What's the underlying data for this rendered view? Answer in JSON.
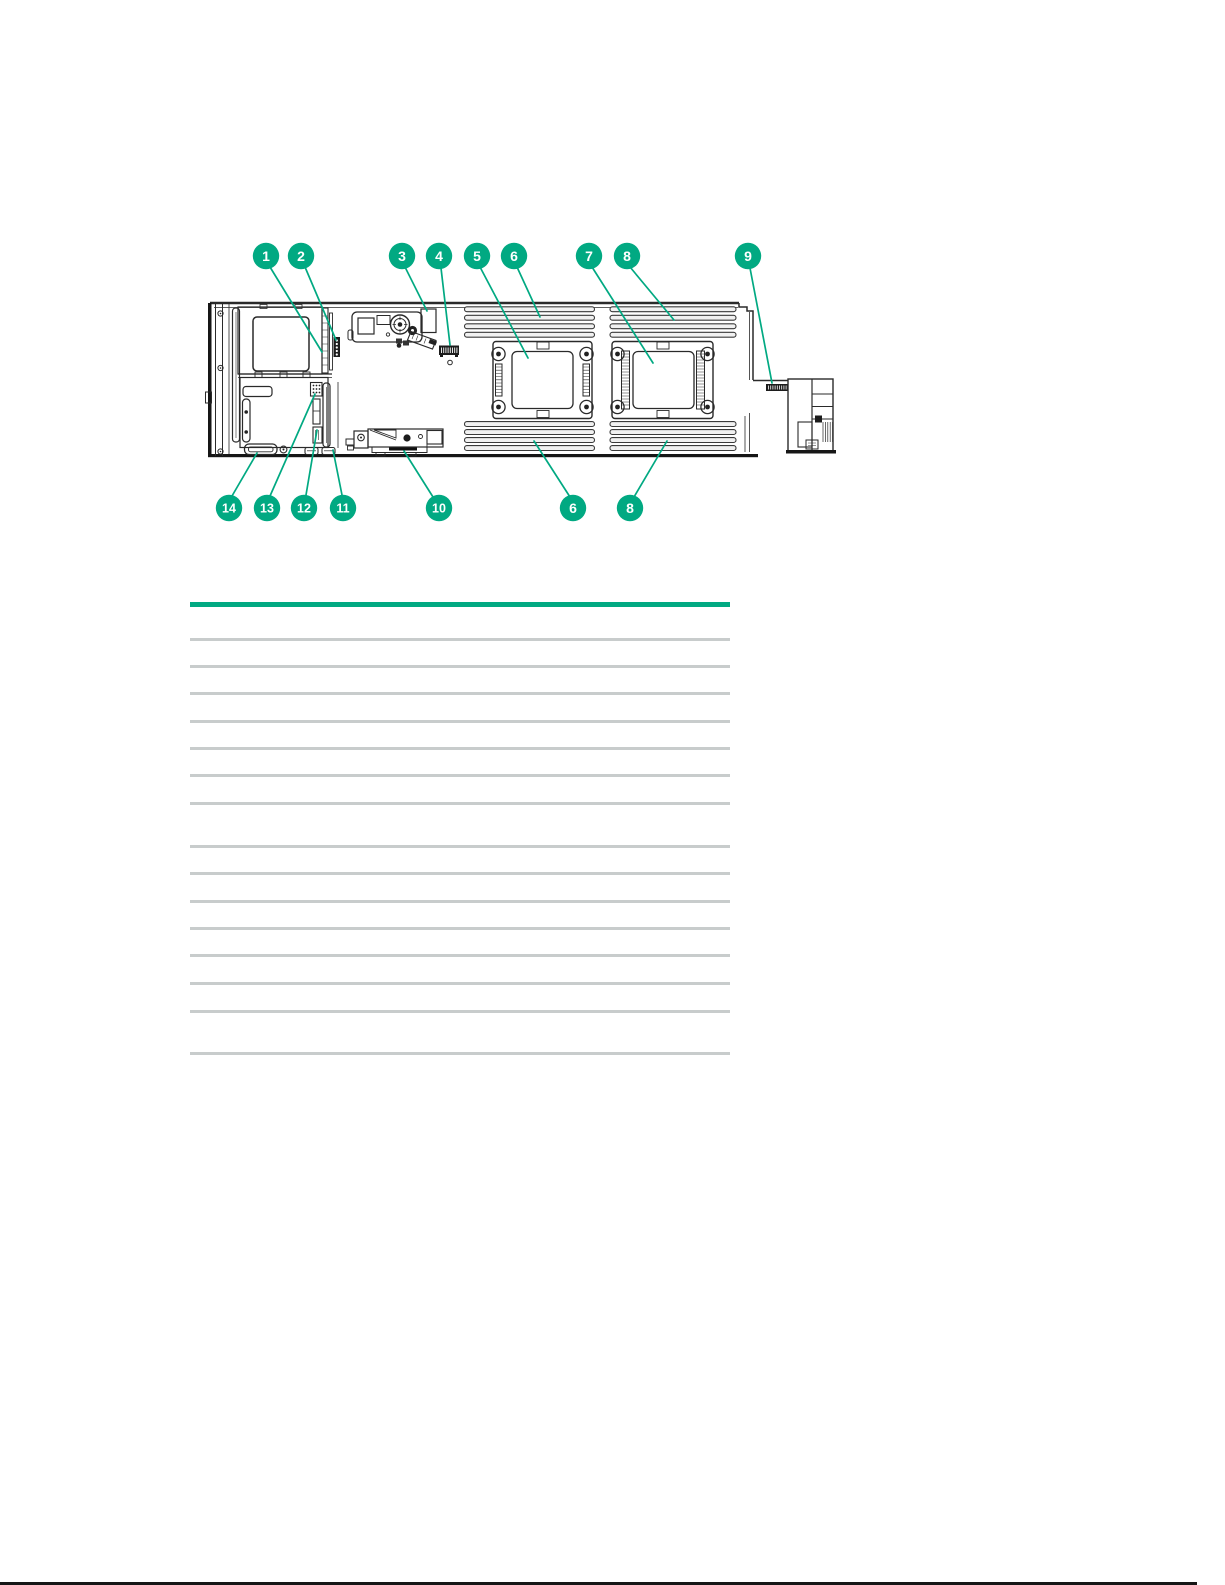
{
  "page": {
    "background": "#FFFFFF",
    "bottom_rule_color": "#161616"
  },
  "accent_color": "#01A982",
  "diagram": {
    "description": "server-blade-system-board-callout-figure",
    "callout_color": "#01A982",
    "leader_color": "#01A982",
    "drawing_line_color": "#2A2A2A",
    "callouts_top": [
      "1",
      "2",
      "3",
      "4",
      "5",
      "6",
      "7",
      "8",
      "9"
    ],
    "callouts_bottom": [
      "14",
      "13",
      "12",
      "11",
      "10",
      "6",
      "8"
    ]
  },
  "table": {
    "header_rule_color": "#01A982",
    "row_rule_color": "#C8CCCC"
  }
}
